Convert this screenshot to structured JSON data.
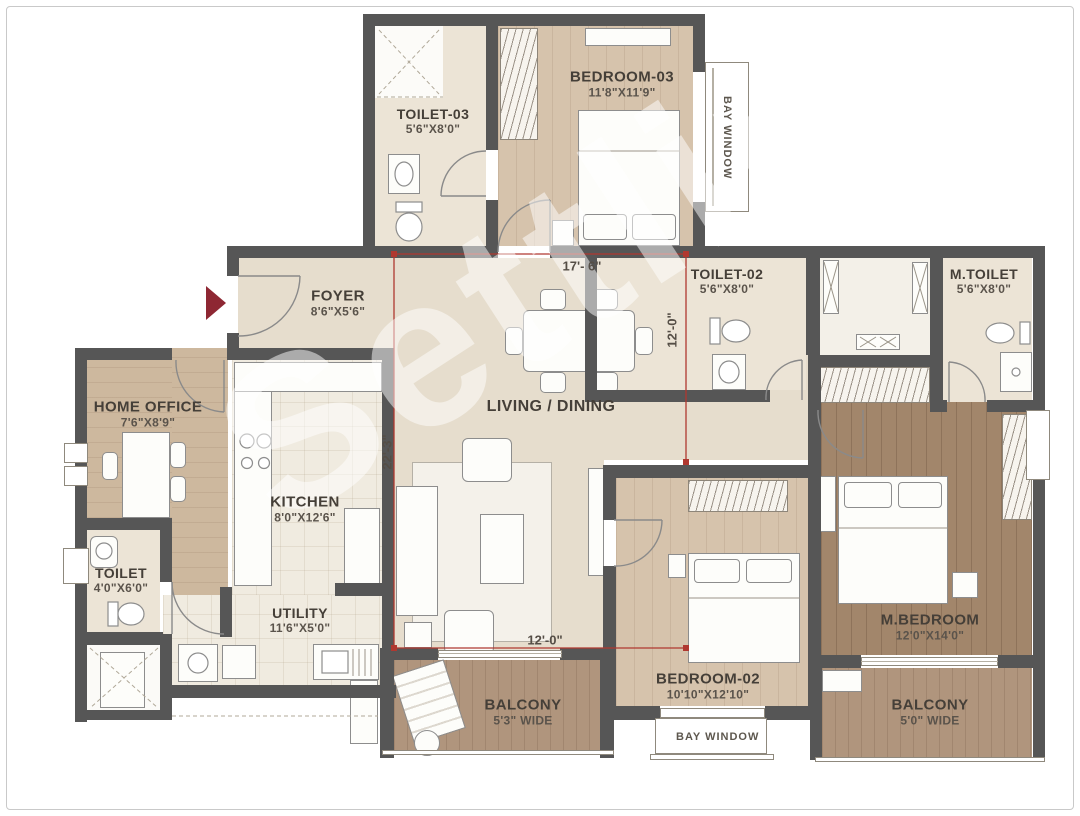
{
  "watermark": "Settlin",
  "rooms": {
    "toilet3": {
      "name": "TOILET-03",
      "dims": "5'6\"X8'0\""
    },
    "bedroom3": {
      "name": "BEDROOM-03",
      "dims": "11'8\"X11'9\""
    },
    "foyer": {
      "name": "FOYER",
      "dims": "8'6\"X5'6\""
    },
    "toilet2": {
      "name": "TOILET-02",
      "dims": "5'6\"X8'0\""
    },
    "mtoilet": {
      "name": "M.TOILET",
      "dims": "5'6\"X8'0\""
    },
    "living": {
      "name": "LIVING / DINING"
    },
    "home_office": {
      "name": "HOME OFFICE",
      "dims": "7'6\"X8'9\""
    },
    "kitchen": {
      "name": "KITCHEN",
      "dims": "8'0\"X12'6\""
    },
    "toilet": {
      "name": "TOILET",
      "dims": "4'0\"X6'0\""
    },
    "utility": {
      "name": "UTILITY",
      "dims": "11'6\"X5'0\""
    },
    "balcony1": {
      "name": "BALCONY",
      "dims": "5'3\" WIDE"
    },
    "bedroom2": {
      "name": "BEDROOM-02",
      "dims": "10'10\"X12'10\""
    },
    "mbedroom": {
      "name": "M.BEDROOM",
      "dims": "12'0\"X14'0\""
    },
    "balcony2": {
      "name": "BALCONY",
      "dims": "5'0\" WIDE"
    }
  },
  "bay_windows": {
    "right": "BAY WINDOW",
    "bottom": "BAY WINDOW"
  },
  "dimensions": {
    "top": "17'- 6\"",
    "right_vertical": "12'-0\"",
    "left_vertical": "22'-3\"",
    "bottom": "12'-0\""
  }
}
